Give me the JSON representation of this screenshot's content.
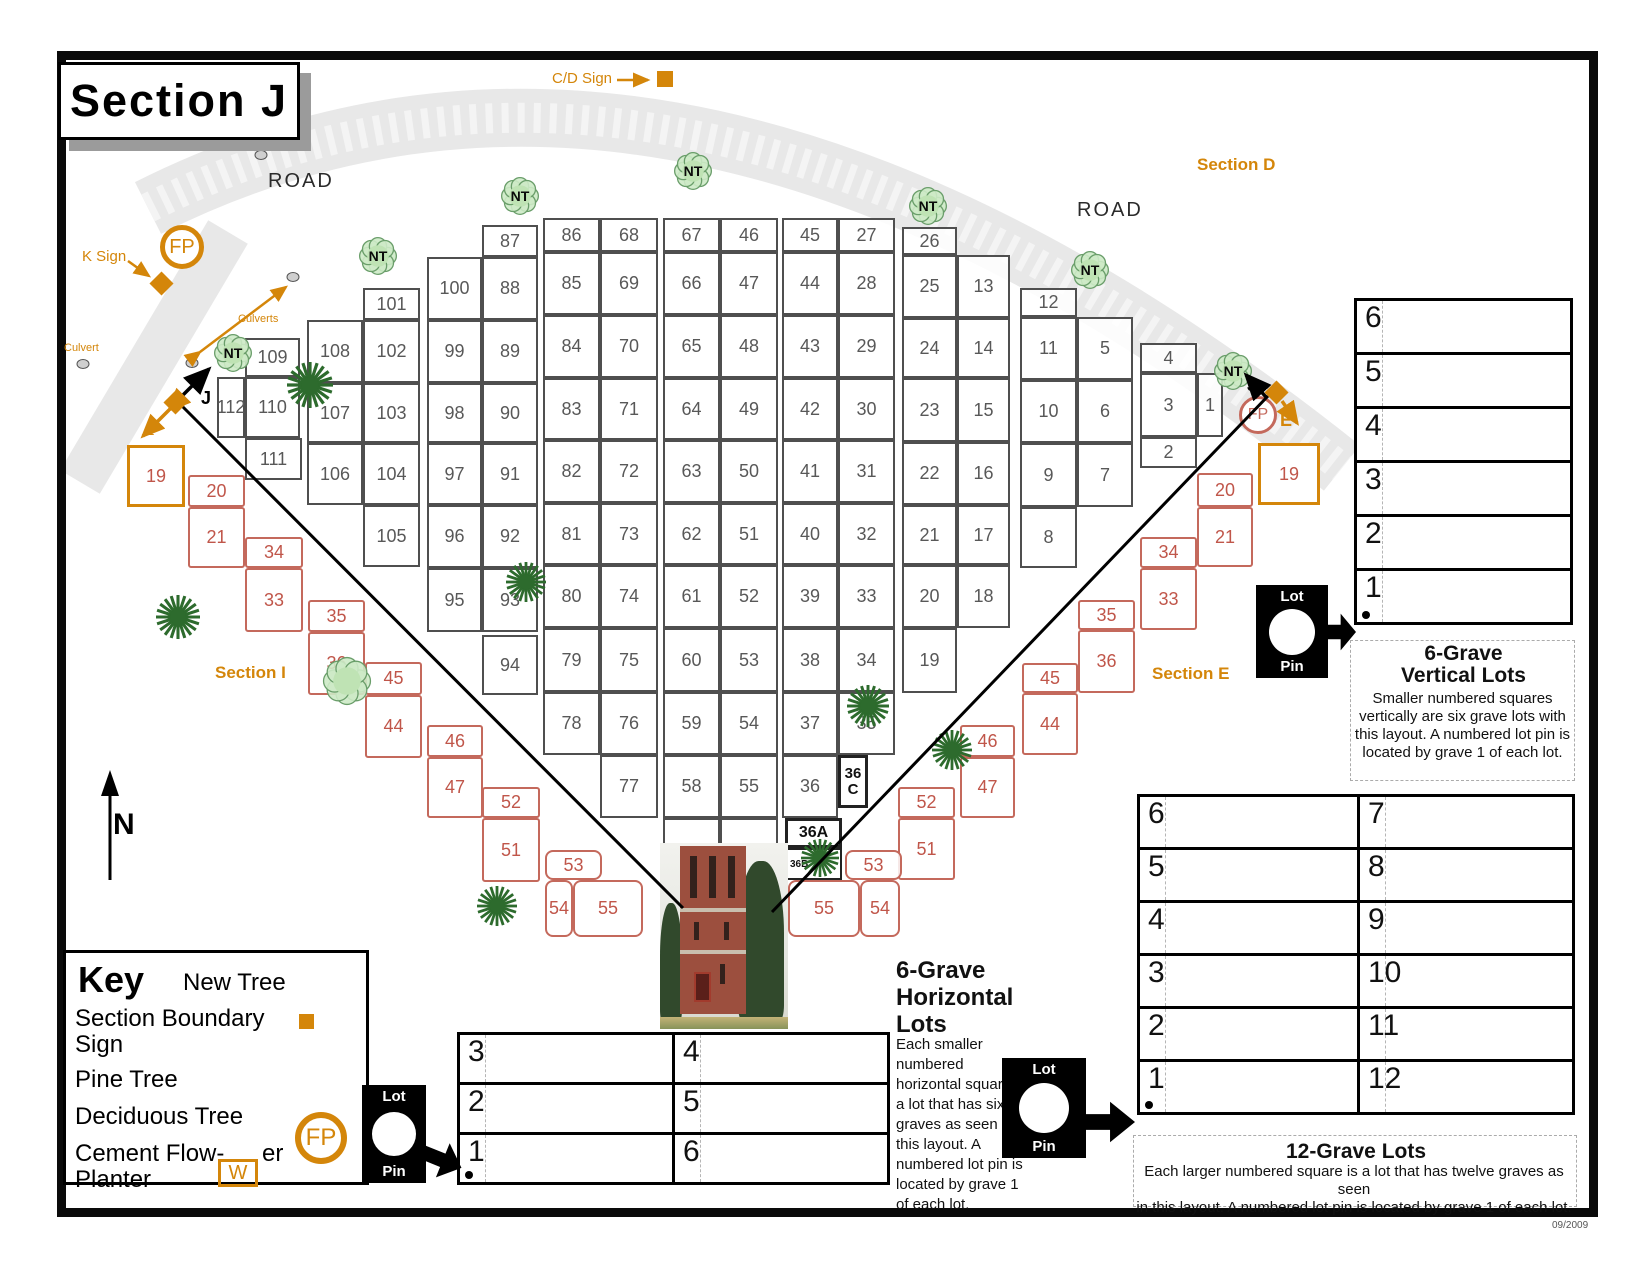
{
  "page": {
    "title": "Section J",
    "date": "09/2009"
  },
  "labels": {
    "road_left": "ROAD",
    "road_right": "ROAD",
    "section_d": "Section D",
    "section_i": "Section I",
    "section_e": "Section E",
    "cd_sign": "C/D Sign",
    "k_sign": "K Sign",
    "culvert": "Culvert",
    "culverts": "Culverts",
    "north": "N",
    "fp": "FP",
    "w": "W",
    "j_left": "J",
    "i_left": "I",
    "j_right": "J",
    "e_right": "E"
  },
  "key": {
    "title": "Key",
    "new_tree": "New Tree",
    "section_boundary_1": "Section Boundary",
    "section_boundary_2": "Sign",
    "pine_tree": "Pine Tree",
    "deciduous_tree": "Deciduous Tree",
    "cement_1": "Cement Flow-",
    "cement_2": "er",
    "cement_3": "Planter"
  },
  "lot_pin": {
    "top": "Lot",
    "bottom": "Pin"
  },
  "panels": {
    "vertical6": {
      "rows": [
        "6",
        "5",
        "4",
        "3",
        "2",
        "1"
      ],
      "title1": "6-Grave",
      "title2": "Vertical Lots",
      "desc": [
        "Smaller numbered squares",
        "vertically are six grave lots with",
        "this layout.  A numbered lot pin is",
        "located by grave 1 of each lot."
      ]
    },
    "horizontal6": {
      "left_rows": [
        "3",
        "2",
        "1"
      ],
      "right_rows": [
        "4",
        "5",
        "6"
      ],
      "title": [
        "6-Grave",
        "Horizontal",
        "Lots"
      ],
      "desc": [
        "Each smaller",
        "numbered",
        "horizontal square is",
        "a lot that has six",
        "graves as seen in",
        "this layout.  A",
        "numbered lot pin is",
        "located by grave 1",
        "of each lot."
      ]
    },
    "twelve": {
      "left_rows": [
        "6",
        "5",
        "4",
        "3",
        "2",
        "1"
      ],
      "right_rows": [
        "7",
        "8",
        "9",
        "10",
        "11",
        "12"
      ],
      "title": "12-Grave Lots",
      "desc": [
        "Each larger numbered square is a lot that has twelve graves as seen",
        "in this layout.  A numbered lot pin is located by grave 1 of each lot."
      ]
    }
  },
  "map": {
    "white_cells": [
      {
        "n": "109",
        "x": 245,
        "y": 338,
        "w": 55,
        "h": 39
      },
      {
        "n": "110",
        "x": 245,
        "y": 377,
        "w": 55,
        "h": 61
      },
      {
        "n": "111",
        "x": 245,
        "y": 438,
        "w": 57,
        "h": 42
      },
      {
        "n": "112",
        "x": 217,
        "y": 377,
        "w": 28,
        "h": 61
      },
      {
        "n": "101",
        "x": 363,
        "y": 288,
        "w": 57,
        "h": 32
      },
      {
        "n": "108",
        "x": 307,
        "y": 320,
        "w": 56,
        "h": 63
      },
      {
        "n": "102",
        "x": 363,
        "y": 320,
        "w": 57,
        "h": 63
      },
      {
        "n": "107",
        "x": 307,
        "y": 383,
        "w": 56,
        "h": 60
      },
      {
        "n": "103",
        "x": 363,
        "y": 383,
        "w": 57,
        "h": 60
      },
      {
        "n": "106",
        "x": 307,
        "y": 443,
        "w": 56,
        "h": 62
      },
      {
        "n": "104",
        "x": 363,
        "y": 443,
        "w": 57,
        "h": 62
      },
      {
        "n": "105",
        "x": 363,
        "y": 505,
        "w": 57,
        "h": 62
      },
      {
        "n": "87",
        "x": 482,
        "y": 225,
        "w": 56,
        "h": 32
      },
      {
        "n": "100",
        "x": 427,
        "y": 257,
        "w": 55,
        "h": 63
      },
      {
        "n": "88",
        "x": 482,
        "y": 257,
        "w": 56,
        "h": 63
      },
      {
        "n": "99",
        "x": 427,
        "y": 320,
        "w": 55,
        "h": 63
      },
      {
        "n": "89",
        "x": 482,
        "y": 320,
        "w": 56,
        "h": 63
      },
      {
        "n": "98",
        "x": 427,
        "y": 383,
        "w": 55,
        "h": 60
      },
      {
        "n": "90",
        "x": 482,
        "y": 383,
        "w": 56,
        "h": 60
      },
      {
        "n": "97",
        "x": 427,
        "y": 443,
        "w": 55,
        "h": 62
      },
      {
        "n": "91",
        "x": 482,
        "y": 443,
        "w": 56,
        "h": 62
      },
      {
        "n": "96",
        "x": 427,
        "y": 505,
        "w": 55,
        "h": 63
      },
      {
        "n": "92",
        "x": 482,
        "y": 505,
        "w": 56,
        "h": 63
      },
      {
        "n": "95",
        "x": 427,
        "y": 568,
        "w": 55,
        "h": 64
      },
      {
        "n": "93",
        "x": 482,
        "y": 568,
        "w": 56,
        "h": 64
      },
      {
        "n": "94",
        "x": 482,
        "y": 635,
        "w": 56,
        "h": 60
      },
      {
        "n": "86",
        "x": 543,
        "y": 218,
        "w": 57,
        "h": 34
      },
      {
        "n": "68",
        "x": 600,
        "y": 218,
        "w": 58,
        "h": 34
      },
      {
        "n": "85",
        "x": 543,
        "y": 252,
        "w": 57,
        "h": 63
      },
      {
        "n": "69",
        "x": 600,
        "y": 252,
        "w": 58,
        "h": 63
      },
      {
        "n": "84",
        "x": 543,
        "y": 315,
        "w": 57,
        "h": 63
      },
      {
        "n": "70",
        "x": 600,
        "y": 315,
        "w": 58,
        "h": 63
      },
      {
        "n": "83",
        "x": 543,
        "y": 378,
        "w": 57,
        "h": 62
      },
      {
        "n": "71",
        "x": 600,
        "y": 378,
        "w": 58,
        "h": 62
      },
      {
        "n": "82",
        "x": 543,
        "y": 440,
        "w": 57,
        "h": 63
      },
      {
        "n": "72",
        "x": 600,
        "y": 440,
        "w": 58,
        "h": 63
      },
      {
        "n": "81",
        "x": 543,
        "y": 503,
        "w": 57,
        "h": 62
      },
      {
        "n": "73",
        "x": 600,
        "y": 503,
        "w": 58,
        "h": 62
      },
      {
        "n": "80",
        "x": 543,
        "y": 565,
        "w": 57,
        "h": 63
      },
      {
        "n": "74",
        "x": 600,
        "y": 565,
        "w": 58,
        "h": 63
      },
      {
        "n": "79",
        "x": 543,
        "y": 628,
        "w": 57,
        "h": 64
      },
      {
        "n": "75",
        "x": 600,
        "y": 628,
        "w": 58,
        "h": 64
      },
      {
        "n": "78",
        "x": 543,
        "y": 692,
        "w": 57,
        "h": 63
      },
      {
        "n": "76",
        "x": 600,
        "y": 692,
        "w": 58,
        "h": 63
      },
      {
        "n": "77",
        "x": 600,
        "y": 755,
        "w": 58,
        "h": 63
      },
      {
        "n": "67",
        "x": 663,
        "y": 218,
        "w": 57,
        "h": 34
      },
      {
        "n": "46",
        "x": 720,
        "y": 218,
        "w": 58,
        "h": 34
      },
      {
        "n": "66",
        "x": 663,
        "y": 252,
        "w": 57,
        "h": 63
      },
      {
        "n": "47",
        "x": 720,
        "y": 252,
        "w": 58,
        "h": 63
      },
      {
        "n": "65",
        "x": 663,
        "y": 315,
        "w": 57,
        "h": 63
      },
      {
        "n": "48",
        "x": 720,
        "y": 315,
        "w": 58,
        "h": 63
      },
      {
        "n": "64",
        "x": 663,
        "y": 378,
        "w": 57,
        "h": 62
      },
      {
        "n": "49",
        "x": 720,
        "y": 378,
        "w": 58,
        "h": 62
      },
      {
        "n": "63",
        "x": 663,
        "y": 440,
        "w": 57,
        "h": 63
      },
      {
        "n": "50",
        "x": 720,
        "y": 440,
        "w": 58,
        "h": 63
      },
      {
        "n": "62",
        "x": 663,
        "y": 503,
        "w": 57,
        "h": 62
      },
      {
        "n": "51",
        "x": 720,
        "y": 503,
        "w": 58,
        "h": 62
      },
      {
        "n": "61",
        "x": 663,
        "y": 565,
        "w": 57,
        "h": 63
      },
      {
        "n": "52",
        "x": 720,
        "y": 565,
        "w": 58,
        "h": 63
      },
      {
        "n": "60",
        "x": 663,
        "y": 628,
        "w": 57,
        "h": 64
      },
      {
        "n": "53",
        "x": 720,
        "y": 628,
        "w": 58,
        "h": 64
      },
      {
        "n": "59",
        "x": 663,
        "y": 692,
        "w": 57,
        "h": 63
      },
      {
        "n": "54",
        "x": 720,
        "y": 692,
        "w": 58,
        "h": 63
      },
      {
        "n": "58",
        "x": 663,
        "y": 755,
        "w": 57,
        "h": 63
      },
      {
        "n": "55",
        "x": 720,
        "y": 755,
        "w": 58,
        "h": 63
      },
      {
        "n": "",
        "x": 663,
        "y": 818,
        "w": 57,
        "h": 60
      },
      {
        "n": "",
        "x": 720,
        "y": 818,
        "w": 58,
        "h": 60
      },
      {
        "n": "45",
        "x": 782,
        "y": 218,
        "w": 56,
        "h": 34
      },
      {
        "n": "27",
        "x": 838,
        "y": 218,
        "w": 57,
        "h": 34
      },
      {
        "n": "44",
        "x": 782,
        "y": 252,
        "w": 56,
        "h": 63
      },
      {
        "n": "28",
        "x": 838,
        "y": 252,
        "w": 57,
        "h": 63
      },
      {
        "n": "43",
        "x": 782,
        "y": 315,
        "w": 56,
        "h": 63
      },
      {
        "n": "29",
        "x": 838,
        "y": 315,
        "w": 57,
        "h": 63
      },
      {
        "n": "42",
        "x": 782,
        "y": 378,
        "w": 56,
        "h": 62
      },
      {
        "n": "30",
        "x": 838,
        "y": 378,
        "w": 57,
        "h": 62
      },
      {
        "n": "41",
        "x": 782,
        "y": 440,
        "w": 56,
        "h": 63
      },
      {
        "n": "31",
        "x": 838,
        "y": 440,
        "w": 57,
        "h": 63
      },
      {
        "n": "40",
        "x": 782,
        "y": 503,
        "w": 56,
        "h": 62
      },
      {
        "n": "32",
        "x": 838,
        "y": 503,
        "w": 57,
        "h": 62
      },
      {
        "n": "39",
        "x": 782,
        "y": 565,
        "w": 56,
        "h": 63
      },
      {
        "n": "33",
        "x": 838,
        "y": 565,
        "w": 57,
        "h": 63
      },
      {
        "n": "38",
        "x": 782,
        "y": 628,
        "w": 56,
        "h": 64
      },
      {
        "n": "34",
        "x": 838,
        "y": 628,
        "w": 57,
        "h": 64
      },
      {
        "n": "37",
        "x": 782,
        "y": 692,
        "w": 56,
        "h": 63
      },
      {
        "n": "35",
        "x": 838,
        "y": 692,
        "w": 57,
        "h": 63
      },
      {
        "n": "36",
        "x": 782,
        "y": 755,
        "w": 56,
        "h": 63
      },
      {
        "n": "26",
        "x": 902,
        "y": 227,
        "w": 55,
        "h": 28
      },
      {
        "n": "25",
        "x": 902,
        "y": 255,
        "w": 55,
        "h": 63
      },
      {
        "n": "13",
        "x": 957,
        "y": 255,
        "w": 53,
        "h": 63
      },
      {
        "n": "24",
        "x": 902,
        "y": 318,
        "w": 55,
        "h": 60
      },
      {
        "n": "14",
        "x": 957,
        "y": 318,
        "w": 53,
        "h": 60
      },
      {
        "n": "23",
        "x": 902,
        "y": 378,
        "w": 55,
        "h": 64
      },
      {
        "n": "15",
        "x": 957,
        "y": 378,
        "w": 53,
        "h": 64
      },
      {
        "n": "22",
        "x": 902,
        "y": 442,
        "w": 55,
        "h": 63
      },
      {
        "n": "16",
        "x": 957,
        "y": 442,
        "w": 53,
        "h": 63
      },
      {
        "n": "21",
        "x": 902,
        "y": 505,
        "w": 55,
        "h": 60
      },
      {
        "n": "17",
        "x": 957,
        "y": 505,
        "w": 53,
        "h": 60
      },
      {
        "n": "20",
        "x": 902,
        "y": 565,
        "w": 55,
        "h": 63
      },
      {
        "n": "18",
        "x": 957,
        "y": 565,
        "w": 53,
        "h": 63
      },
      {
        "n": "19",
        "x": 902,
        "y": 628,
        "w": 55,
        "h": 65
      },
      {
        "n": "12",
        "x": 1020,
        "y": 288,
        "w": 57,
        "h": 29
      },
      {
        "n": "11",
        "x": 1020,
        "y": 317,
        "w": 57,
        "h": 63
      },
      {
        "n": "5",
        "x": 1077,
        "y": 317,
        "w": 56,
        "h": 63
      },
      {
        "n": "10",
        "x": 1020,
        "y": 380,
        "w": 57,
        "h": 63
      },
      {
        "n": "6",
        "x": 1077,
        "y": 380,
        "w": 56,
        "h": 63
      },
      {
        "n": "9",
        "x": 1020,
        "y": 443,
        "w": 57,
        "h": 64
      },
      {
        "n": "7",
        "x": 1077,
        "y": 443,
        "w": 56,
        "h": 64
      },
      {
        "n": "8",
        "x": 1020,
        "y": 507,
        "w": 57,
        "h": 61
      },
      {
        "n": "4",
        "x": 1140,
        "y": 343,
        "w": 57,
        "h": 30
      },
      {
        "n": "3",
        "x": 1140,
        "y": 373,
        "w": 57,
        "h": 64
      },
      {
        "n": "1",
        "x": 1197,
        "y": 373,
        "w": 26,
        "h": 64
      },
      {
        "n": "2",
        "x": 1140,
        "y": 437,
        "w": 57,
        "h": 31
      }
    ],
    "special_cells": [
      {
        "n": "36\nC",
        "x": 838,
        "y": 755,
        "w": 30,
        "h": 53,
        "cls": "c36c"
      },
      {
        "n": "36A",
        "x": 785,
        "y": 818,
        "w": 57,
        "h": 30,
        "cls": "c36a"
      },
      {
        "n": "36B",
        "x": 785,
        "y": 848,
        "w": 57,
        "h": 32,
        "cls": "c36b"
      }
    ],
    "salmon_cells": [
      {
        "n": "20",
        "x": 188,
        "y": 475,
        "w": 57,
        "h": 32
      },
      {
        "n": "21",
        "x": 188,
        "y": 507,
        "w": 57,
        "h": 61
      },
      {
        "n": "34",
        "x": 245,
        "y": 537,
        "w": 58,
        "h": 31
      },
      {
        "n": "33",
        "x": 245,
        "y": 568,
        "w": 58,
        "h": 64
      },
      {
        "n": "35",
        "x": 308,
        "y": 600,
        "w": 57,
        "h": 32
      },
      {
        "n": "36",
        "x": 308,
        "y": 632,
        "w": 57,
        "h": 63
      },
      {
        "n": "45",
        "x": 365,
        "y": 662,
        "w": 57,
        "h": 33
      },
      {
        "n": "44",
        "x": 365,
        "y": 695,
        "w": 57,
        "h": 63
      },
      {
        "n": "46",
        "x": 427,
        "y": 725,
        "w": 56,
        "h": 32
      },
      {
        "n": "47",
        "x": 427,
        "y": 757,
        "w": 56,
        "h": 61
      },
      {
        "n": "52",
        "x": 482,
        "y": 787,
        "w": 58,
        "h": 31
      },
      {
        "n": "51",
        "x": 482,
        "y": 818,
        "w": 58,
        "h": 64
      },
      {
        "n": "53",
        "x": 545,
        "y": 850,
        "w": 57,
        "h": 30,
        "rnd": true
      },
      {
        "n": "54",
        "x": 545,
        "y": 880,
        "w": 28,
        "h": 57,
        "rnd": true
      },
      {
        "n": "55",
        "x": 573,
        "y": 880,
        "w": 70,
        "h": 57,
        "rnd": true
      },
      {
        "n": "20",
        "x": 1197,
        "y": 473,
        "w": 56,
        "h": 34
      },
      {
        "n": "21",
        "x": 1197,
        "y": 507,
        "w": 56,
        "h": 60
      },
      {
        "n": "34",
        "x": 1140,
        "y": 537,
        "w": 57,
        "h": 31
      },
      {
        "n": "33",
        "x": 1140,
        "y": 568,
        "w": 57,
        "h": 62
      },
      {
        "n": "35",
        "x": 1078,
        "y": 600,
        "w": 57,
        "h": 30
      },
      {
        "n": "36",
        "x": 1078,
        "y": 630,
        "w": 57,
        "h": 63
      },
      {
        "n": "45",
        "x": 1022,
        "y": 663,
        "w": 56,
        "h": 30
      },
      {
        "n": "44",
        "x": 1022,
        "y": 693,
        "w": 56,
        "h": 62
      },
      {
        "n": "46",
        "x": 960,
        "y": 725,
        "w": 55,
        "h": 32
      },
      {
        "n": "47",
        "x": 960,
        "y": 757,
        "w": 55,
        "h": 61
      },
      {
        "n": "52",
        "x": 898,
        "y": 787,
        "w": 57,
        "h": 31
      },
      {
        "n": "51",
        "x": 898,
        "y": 818,
        "w": 57,
        "h": 62
      },
      {
        "n": "53",
        "x": 845,
        "y": 850,
        "w": 57,
        "h": 30,
        "rnd": true
      },
      {
        "n": "55",
        "x": 788,
        "y": 880,
        "w": 72,
        "h": 57,
        "rnd": true
      },
      {
        "n": "54",
        "x": 860,
        "y": 880,
        "w": 40,
        "h": 57,
        "rnd": true
      }
    ],
    "orange_cells": [
      {
        "n": "19",
        "x": 127,
        "y": 445,
        "w": 58,
        "h": 62
      },
      {
        "n": "19",
        "x": 1258,
        "y": 443,
        "w": 62,
        "h": 62
      }
    ],
    "trees": {
      "nt_label": "NT",
      "nt": [
        [
          378,
          256
        ],
        [
          520,
          196
        ],
        [
          693,
          171
        ],
        [
          928,
          206
        ],
        [
          1090,
          270
        ],
        [
          233,
          353
        ],
        [
          1233,
          371
        ]
      ],
      "pine": [
        [
          310,
          385,
          46
        ],
        [
          526,
          582,
          40
        ],
        [
          868,
          706,
          42
        ],
        [
          178,
          617,
          44
        ],
        [
          497,
          906,
          40
        ],
        [
          952,
          750,
          40
        ],
        [
          820,
          858,
          38
        ]
      ],
      "deciduous": [
        [
          347,
          681,
          46
        ]
      ]
    }
  },
  "colors": {
    "orange": "#d4860a",
    "salmon": "#c0564a",
    "road": "#e8e8e8",
    "grid": "#4f4f4f"
  }
}
